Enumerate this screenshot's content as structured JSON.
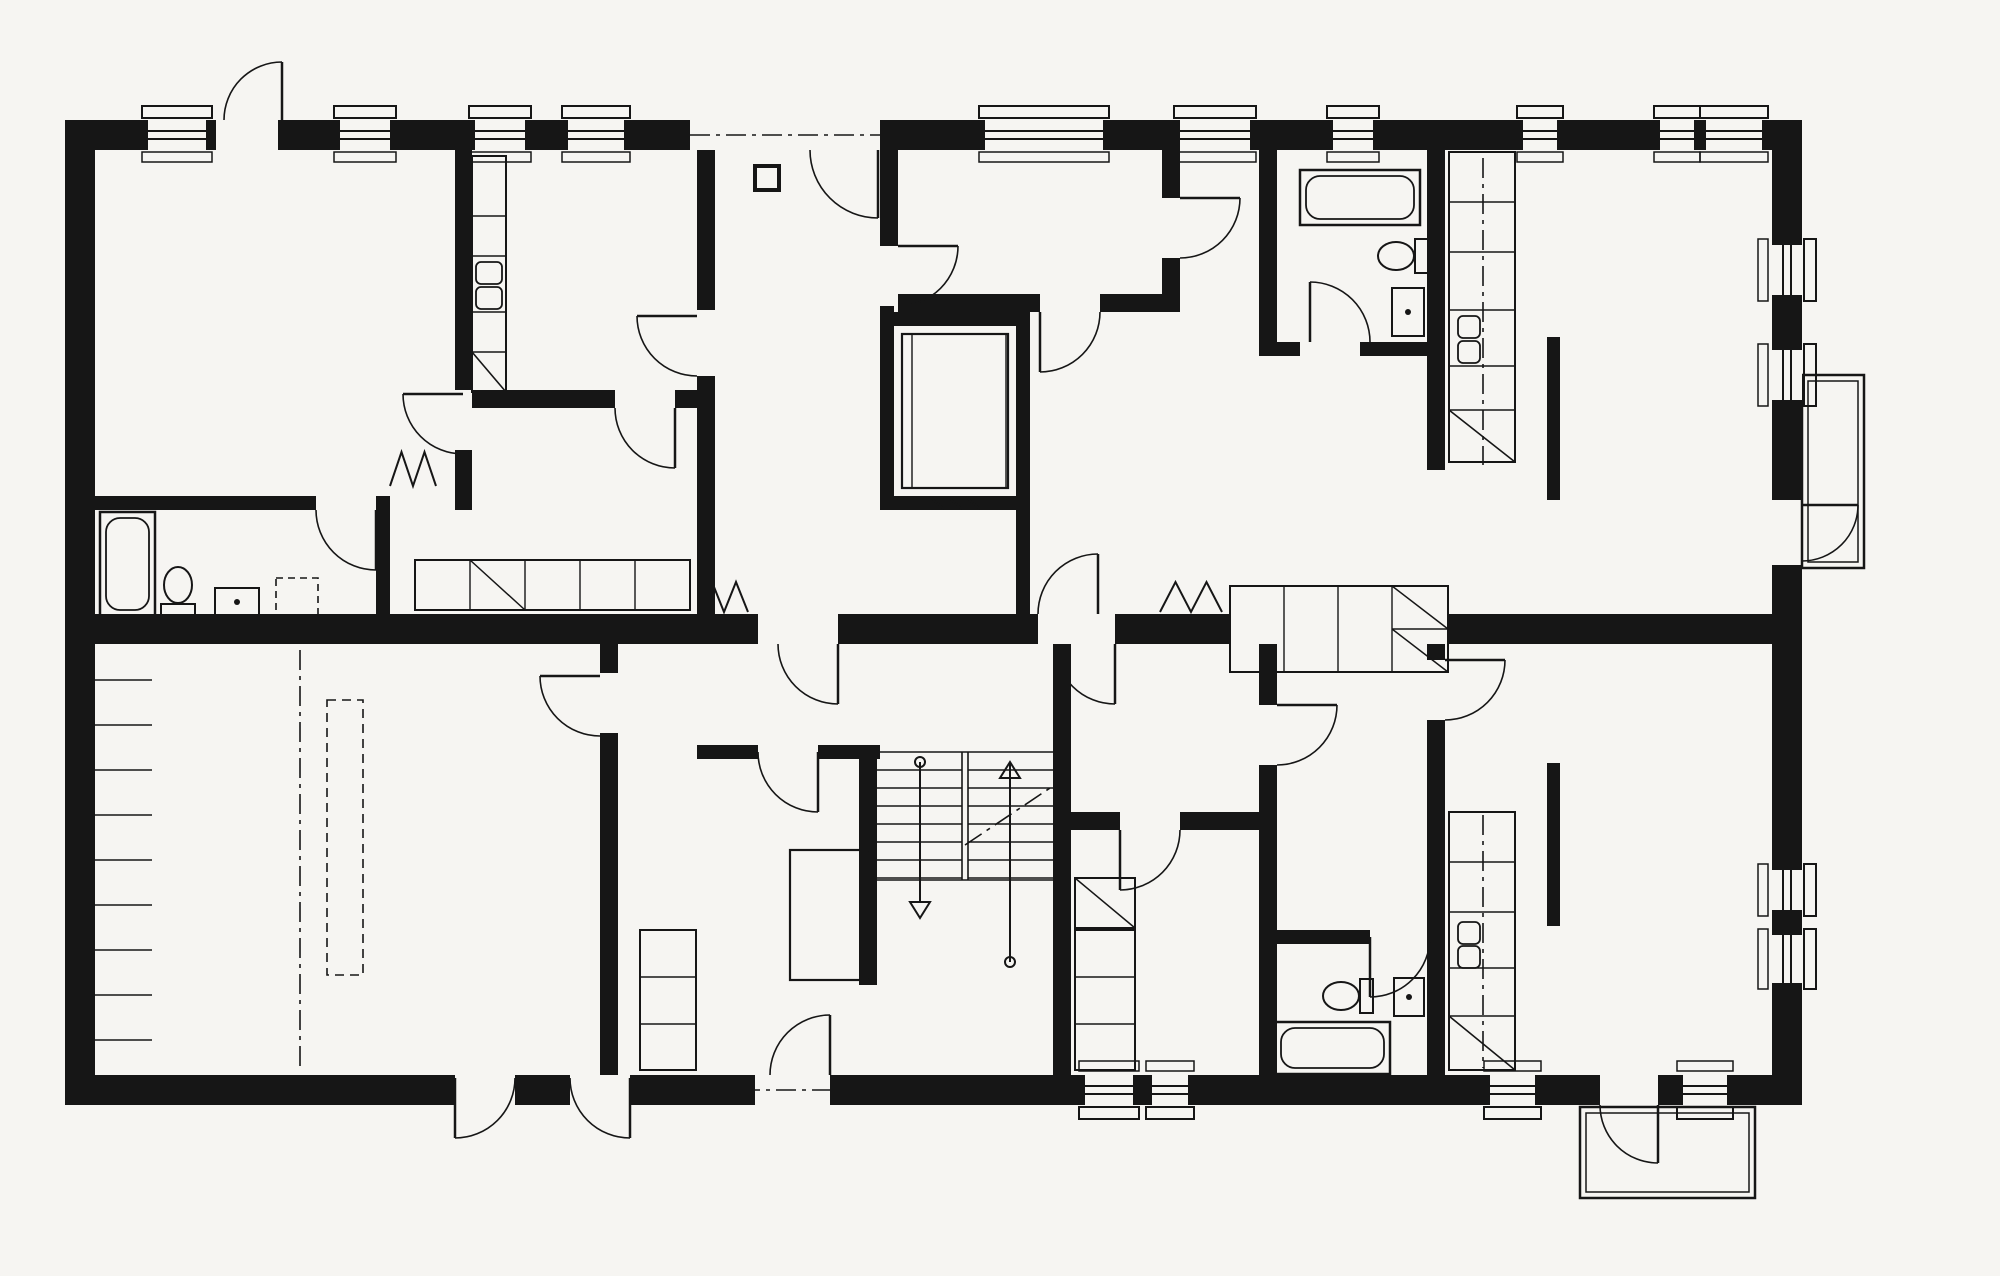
{
  "plan": {
    "canvas": {
      "w": 2000,
      "h": 1276
    },
    "colors": {
      "paper": "#f6f5f2",
      "ink": "#161616"
    },
    "walls": [
      [
        65,
        120,
        83,
        30
      ],
      [
        206,
        120,
        10,
        30
      ],
      [
        278,
        120,
        62,
        30
      ],
      [
        390,
        120,
        85,
        30
      ],
      [
        525,
        120,
        43,
        30
      ],
      [
        624,
        120,
        66,
        30
      ],
      [
        880,
        120,
        105,
        30
      ],
      [
        1103,
        120,
        77,
        30
      ],
      [
        1250,
        120,
        83,
        30
      ],
      [
        1373,
        120,
        150,
        30
      ],
      [
        1557,
        120,
        103,
        30
      ],
      [
        1694,
        120,
        12,
        30
      ],
      [
        1762,
        120,
        40,
        30
      ],
      [
        65,
        120,
        30,
        985
      ],
      [
        65,
        1075,
        390,
        30
      ],
      [
        515,
        1075,
        55,
        30
      ],
      [
        630,
        1075,
        125,
        30
      ],
      [
        830,
        1075,
        255,
        30
      ],
      [
        1133,
        1075,
        19,
        30
      ],
      [
        1188,
        1075,
        302,
        30
      ],
      [
        1535,
        1075,
        65,
        30
      ],
      [
        1658,
        1075,
        25,
        30
      ],
      [
        1727,
        1075,
        75,
        30
      ],
      [
        1772,
        120,
        30,
        125
      ],
      [
        1772,
        295,
        30,
        55
      ],
      [
        1772,
        400,
        30,
        100
      ],
      [
        1772,
        565,
        30,
        305
      ],
      [
        1772,
        910,
        30,
        25
      ],
      [
        1772,
        983,
        30,
        122
      ],
      [
        697,
        150,
        18,
        160
      ],
      [
        697,
        376,
        18,
        238
      ],
      [
        880,
        150,
        18,
        96
      ],
      [
        898,
        294,
        142,
        18
      ],
      [
        1100,
        294,
        80,
        18
      ],
      [
        1162,
        150,
        18,
        48
      ],
      [
        1162,
        258,
        18,
        36
      ],
      [
        880,
        306,
        14,
        204
      ],
      [
        880,
        312,
        150,
        14
      ],
      [
        1016,
        312,
        14,
        198
      ],
      [
        880,
        496,
        150,
        14
      ],
      [
        1016,
        510,
        14,
        104
      ],
      [
        455,
        150,
        17,
        240
      ],
      [
        455,
        450,
        17,
        60
      ],
      [
        472,
        390,
        143,
        18
      ],
      [
        675,
        390,
        22,
        18
      ],
      [
        95,
        496,
        221,
        14
      ],
      [
        376,
        496,
        14,
        118
      ],
      [
        697,
        745,
        61,
        14
      ],
      [
        818,
        745,
        62,
        14
      ],
      [
        95,
        614,
        295,
        30
      ],
      [
        390,
        614,
        307,
        30
      ],
      [
        697,
        614,
        61,
        30
      ],
      [
        838,
        614,
        200,
        30
      ],
      [
        1115,
        614,
        115,
        30
      ],
      [
        1448,
        614,
        324,
        30
      ],
      [
        859,
        745,
        18,
        240
      ],
      [
        1053,
        745,
        18,
        240
      ],
      [
        1053,
        644,
        18,
        101
      ],
      [
        1053,
        985,
        18,
        90
      ],
      [
        600,
        644,
        18,
        29
      ],
      [
        600,
        733,
        18,
        342
      ],
      [
        1071,
        812,
        49,
        18
      ],
      [
        1180,
        812,
        97,
        18
      ],
      [
        1259,
        644,
        18,
        61
      ],
      [
        1259,
        765,
        18,
        310
      ],
      [
        1277,
        930,
        93,
        14
      ],
      [
        1427,
        150,
        18,
        320
      ],
      [
        1427,
        644,
        18,
        16
      ],
      [
        1427,
        720,
        18,
        355
      ],
      [
        1259,
        150,
        18,
        206
      ],
      [
        1259,
        342,
        41,
        14
      ],
      [
        1360,
        342,
        85,
        14
      ]
    ],
    "windows": [
      {
        "wall": "top",
        "pos": 148,
        "len": 58
      },
      {
        "wall": "top",
        "pos": 340,
        "len": 50
      },
      {
        "wall": "top",
        "pos": 475,
        "len": 50
      },
      {
        "wall": "top",
        "pos": 568,
        "len": 56
      },
      {
        "wall": "top",
        "pos": 985,
        "len": 118
      },
      {
        "wall": "top",
        "pos": 1180,
        "len": 70
      },
      {
        "wall": "top",
        "pos": 1333,
        "len": 40
      },
      {
        "wall": "top",
        "pos": 1523,
        "len": 34
      },
      {
        "wall": "top",
        "pos": 1660,
        "len": 34
      },
      {
        "wall": "top",
        "pos": 1706,
        "len": 56
      },
      {
        "wall": "bottom",
        "pos": 1085,
        "len": 48
      },
      {
        "wall": "bottom",
        "pos": 1152,
        "len": 36
      },
      {
        "wall": "bottom",
        "pos": 1490,
        "len": 45
      },
      {
        "wall": "bottom",
        "pos": 1683,
        "len": 44
      },
      {
        "wall": "right",
        "pos": 245,
        "len": 50
      },
      {
        "wall": "right",
        "pos": 350,
        "len": 50
      },
      {
        "wall": "right",
        "pos": 870,
        "len": 40
      },
      {
        "wall": "right",
        "pos": 935,
        "len": 48
      }
    ],
    "doors": [
      {
        "hinge": [
          282,
          120
        ],
        "leaf": [
          282,
          62
        ],
        "end": [
          224,
          120
        ]
      },
      {
        "hinge": [
          878,
          150
        ],
        "leaf": [
          878,
          218
        ],
        "end": [
          810,
          150
        ]
      },
      {
        "hinge": [
          697,
          316
        ],
        "leaf": [
          637,
          316
        ],
        "end": [
          697,
          376
        ]
      },
      {
        "hinge": [
          898,
          246
        ],
        "leaf": [
          958,
          246
        ],
        "end": [
          898,
          306
        ]
      },
      {
        "hinge": [
          376,
          510
        ],
        "leaf": [
          376,
          570
        ],
        "end": [
          316,
          510
        ]
      },
      {
        "hinge": [
          463,
          394
        ],
        "leaf": [
          403,
          394
        ],
        "end": [
          463,
          454
        ]
      },
      {
        "hinge": [
          675,
          408
        ],
        "leaf": [
          675,
          468
        ],
        "end": [
          615,
          408
        ]
      },
      {
        "hinge": [
          600,
          676
        ],
        "leaf": [
          540,
          676
        ],
        "end": [
          600,
          736
        ]
      },
      {
        "hinge": [
          838,
          644
        ],
        "leaf": [
          838,
          704
        ],
        "end": [
          778,
          644
        ]
      },
      {
        "hinge": [
          1098,
          614
        ],
        "leaf": [
          1098,
          554
        ],
        "end": [
          1038,
          614
        ]
      },
      {
        "hinge": [
          1115,
          644
        ],
        "leaf": [
          1115,
          704
        ],
        "end": [
          1055,
          644
        ]
      },
      {
        "hinge": [
          1180,
          198
        ],
        "leaf": [
          1240,
          198
        ],
        "end": [
          1180,
          258
        ]
      },
      {
        "hinge": [
          1310,
          342
        ],
        "leaf": [
          1310,
          282
        ],
        "end": [
          1370,
          342
        ]
      },
      {
        "hinge": [
          1040,
          312
        ],
        "leaf": [
          1040,
          372
        ],
        "end": [
          1100,
          312
        ]
      },
      {
        "hinge": [
          1802,
          505
        ],
        "leaf": [
          1858,
          505
        ],
        "end": [
          1802,
          561
        ]
      },
      {
        "hinge": [
          830,
          1075
        ],
        "leaf": [
          830,
          1015
        ],
        "end": [
          770,
          1075
        ]
      },
      {
        "hinge": [
          1120,
          830
        ],
        "leaf": [
          1120,
          890
        ],
        "end": [
          1180,
          830
        ]
      },
      {
        "hinge": [
          1277,
          705
        ],
        "leaf": [
          1337,
          705
        ],
        "end": [
          1277,
          765
        ]
      },
      {
        "hinge": [
          1370,
          937
        ],
        "leaf": [
          1370,
          997
        ],
        "end": [
          1430,
          937
        ]
      },
      {
        "hinge": [
          1445,
          660
        ],
        "leaf": [
          1505,
          660
        ],
        "end": [
          1445,
          720
        ]
      },
      {
        "hinge": [
          1658,
          1105
        ],
        "leaf": [
          1658,
          1163
        ],
        "end": [
          1600,
          1105
        ]
      },
      {
        "hinge": [
          455,
          1078
        ],
        "leaf": [
          455,
          1138
        ],
        "end": [
          515,
          1078
        ]
      },
      {
        "hinge": [
          630,
          1078
        ],
        "leaf": [
          630,
          1138
        ],
        "end": [
          570,
          1078
        ]
      },
      {
        "hinge": [
          818,
          752
        ],
        "leaf": [
          818,
          812
        ],
        "end": [
          758,
          752
        ]
      }
    ],
    "dashdot": [
      [
        690,
        135,
        880,
        135
      ],
      [
        300,
        650,
        300,
        1070
      ],
      [
        1483,
        158,
        1483,
        465
      ],
      [
        1483,
        815,
        1483,
        1068
      ],
      [
        965,
        845,
        1050,
        788
      ],
      [
        740,
        1090,
        845,
        1090
      ]
    ],
    "hatch_ticks": {
      "x1": 95,
      "x2": 152,
      "ys": [
        680,
        725,
        770,
        815,
        860,
        905,
        950,
        995,
        1040
      ]
    },
    "stairs": {
      "x1": 877,
      "y1": 745,
      "x2": 1053,
      "y2": 985,
      "mid": [
        962,
        968
      ],
      "tread_ys": [
        770,
        788,
        806,
        824,
        842,
        860,
        878
      ],
      "down_arrow": {
        "x": 920,
        "y1": 762,
        "y2": 902
      },
      "up_arrow": {
        "x": 1010,
        "y1": 962,
        "y2": 762
      }
    },
    "elevator": {
      "car": [
        902,
        334,
        106,
        154
      ],
      "inner_x": [
        912,
        1006
      ],
      "hatch": [
        [
          930,
          497,
          944,
          509
        ],
        [
          948,
          497,
          962,
          509
        ],
        [
          966,
          497,
          980,
          509
        ]
      ]
    },
    "balconies": [
      [
        1802,
        375,
        62,
        193
      ],
      [
        1580,
        1107,
        175,
        91
      ]
    ],
    "columns": [
      [
        755,
        166,
        24,
        24
      ]
    ],
    "divider_bars": [
      [
        1547,
        337,
        13,
        163
      ],
      [
        1547,
        763,
        13,
        163
      ]
    ],
    "bathtubs": [
      [
        100,
        512,
        55,
        104
      ],
      [
        1300,
        170,
        120,
        55
      ],
      [
        1275,
        1022,
        115,
        52
      ]
    ],
    "toilets": [
      {
        "t": [
          160,
          566
        ],
        "r": 0
      },
      {
        "t": [
          1377,
          274
        ],
        "r": -90
      },
      {
        "t": [
          1322,
          1014
        ],
        "r": -90
      }
    ],
    "sinks": [
      [
        215,
        588,
        44,
        28
      ],
      [
        1392,
        288,
        32,
        48
      ],
      [
        1394,
        978,
        30,
        38
      ]
    ],
    "washers": [
      [
        276,
        578,
        42,
        40
      ]
    ],
    "dashed_rects": [
      [
        327,
        700,
        36,
        275
      ]
    ],
    "counters": [
      {
        "rect": [
          472,
          156,
          34,
          236
        ],
        "div_ys": [
          216,
          256,
          312,
          352
        ],
        "sink": [
          [
            476,
            262,
            26,
            22
          ],
          [
            476,
            287,
            26,
            22
          ]
        ],
        "fridge": [
          472,
          352,
          34,
          40
        ]
      },
      {
        "rect": [
          1449,
          152,
          66,
          310
        ],
        "div_ys": [
          202,
          252,
          310,
          366,
          410
        ],
        "sink": [
          [
            1458,
            316,
            22,
            22
          ],
          [
            1458,
            341,
            22,
            22
          ]
        ],
        "fridge": [
          1449,
          410,
          66,
          52
        ]
      },
      {
        "rect": [
          1449,
          812,
          66,
          258
        ],
        "div_ys": [
          862,
          912,
          968,
          1016
        ],
        "sink": [
          [
            1458,
            922,
            22,
            22
          ],
          [
            1458,
            946,
            22,
            22
          ]
        ],
        "fridge": [
          1449,
          1016,
          66,
          54
        ]
      }
    ],
    "closets": [
      {
        "rect": [
          415,
          560,
          275,
          50
        ],
        "vlines": [
          470,
          525,
          580,
          635
        ],
        "diags": [
          [
            470,
            560,
            55,
            50
          ]
        ]
      },
      {
        "rect": [
          1230,
          586,
          218,
          86
        ],
        "vlines": [
          1284,
          1338,
          1392
        ],
        "hseg": [
          1392,
          629,
          1448,
          629
        ],
        "diags": [
          [
            1392,
            586,
            56,
            43
          ],
          [
            1392,
            629,
            56,
            43
          ]
        ]
      },
      {
        "rect": [
          640,
          930,
          56,
          140
        ],
        "hlines": [
          977,
          1024
        ]
      },
      {
        "rect": [
          1075,
          930,
          60,
          140
        ],
        "hlines": [
          977,
          1024
        ]
      },
      {
        "rect": [
          1075,
          878,
          60,
          50
        ],
        "diags": [
          [
            1075,
            878,
            60,
            50
          ]
        ]
      }
    ],
    "furniture": [
      [
        790,
        850,
        80,
        130
      ]
    ],
    "radiators": [
      [
        700,
        582,
        48,
        30
      ],
      [
        1160,
        582,
        62,
        30
      ],
      [
        390,
        452,
        46,
        34
      ]
    ]
  }
}
